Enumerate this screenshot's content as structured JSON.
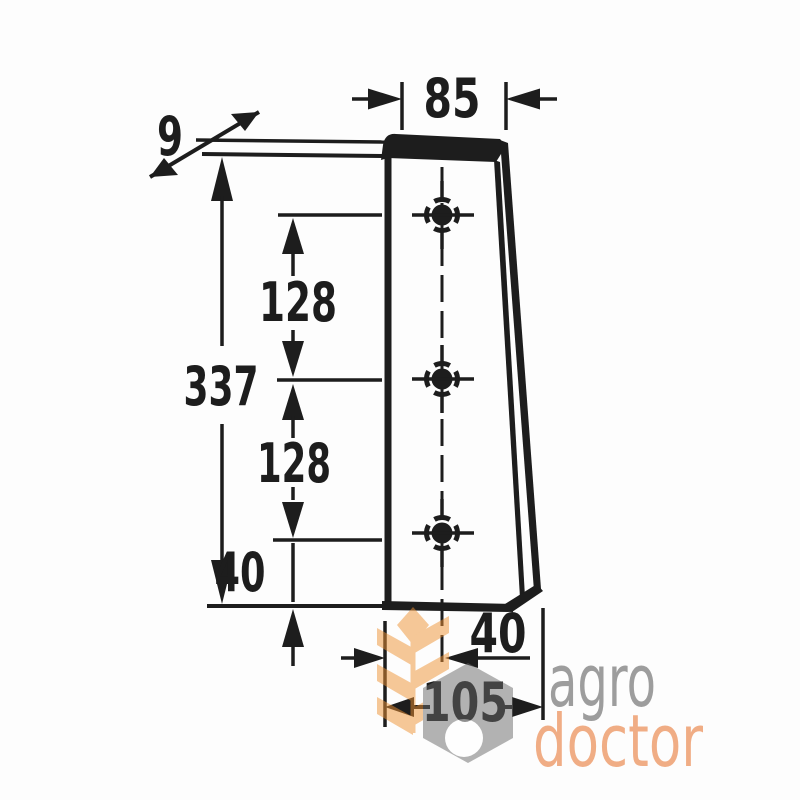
{
  "drawing": {
    "description": "technical dimension drawing of tapered knife blade with three mounting holes",
    "dimensions": {
      "top_width": "85",
      "thickness": "9",
      "overall_length": "337",
      "hole_spacing_upper": "128",
      "hole_spacing_lower": "128",
      "last_hole_to_bottom": "40",
      "hole_offset_horizontal": "40",
      "bottom_width": "105"
    },
    "hole_count": 3
  },
  "watermark": {
    "word1": "agro",
    "word2": "doctor"
  },
  "colors": {
    "ink": "#1d1d1d",
    "paper": "#fdfdfd",
    "wheat": "#ee9233",
    "nut": "#696969",
    "agro": "#3f3f3f",
    "doctor": "#e55f10"
  }
}
